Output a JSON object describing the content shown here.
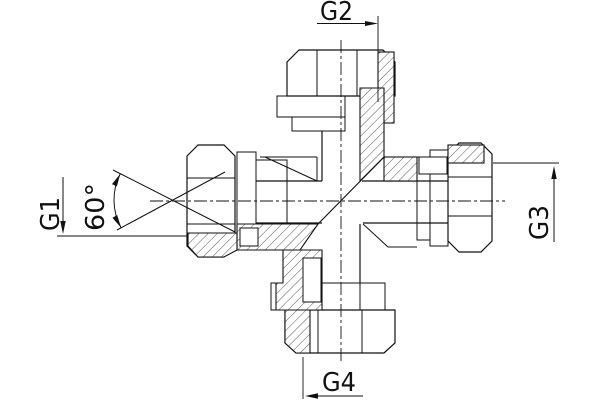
{
  "drawing": {
    "background_color": "#ffffff",
    "line_color": "#111111",
    "annotations": {
      "g1": "G1",
      "g2": "G2",
      "g3": "G3",
      "g4": "G4",
      "cone_angle": "60°"
    }
  }
}
